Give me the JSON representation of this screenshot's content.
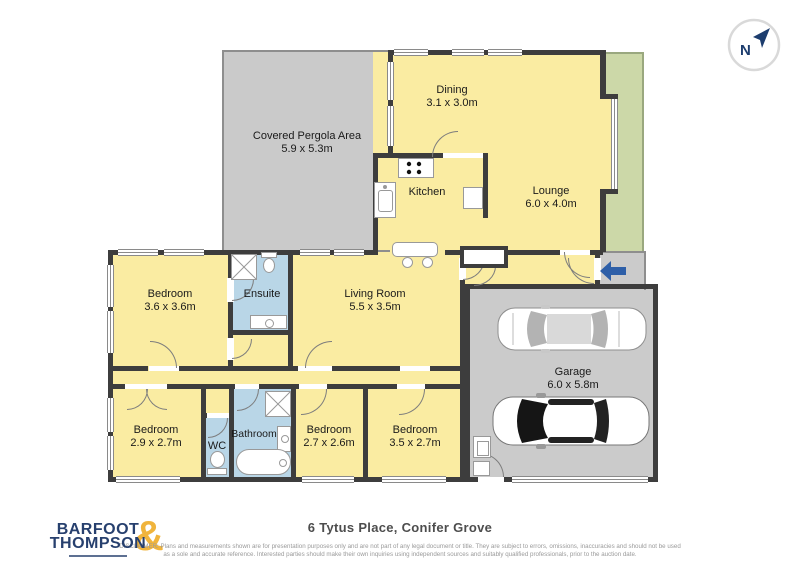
{
  "compass": {
    "label": "N"
  },
  "rooms": {
    "pergola": {
      "name": "Covered Pergola Area",
      "dims": "5.9 x 5.3m"
    },
    "dining": {
      "name": "Dining",
      "dims": "3.1 x 3.0m"
    },
    "kitchen": {
      "name": "Kitchen"
    },
    "lounge": {
      "name": "Lounge",
      "dims": "6.0 x 4.0m"
    },
    "living_room": {
      "name": "Living Room",
      "dims": "5.5 x 3.5m"
    },
    "bedroom_1": {
      "name": "Bedroom",
      "dims": "3.6 x 3.6m"
    },
    "ensuite": {
      "name": "Ensuite"
    },
    "bedroom_2": {
      "name": "Bedroom",
      "dims": "2.9 x 2.7m"
    },
    "wc": {
      "name": "WC"
    },
    "bathroom": {
      "name": "Bathroom"
    },
    "bedroom_3": {
      "name": "Bedroom",
      "dims": "2.7 x 2.6m"
    },
    "bedroom_4": {
      "name": "Bedroom",
      "dims": "3.5 x 2.7m"
    },
    "garage": {
      "name": "Garage",
      "dims": "6.0 x 5.8m"
    }
  },
  "footer": {
    "title": "6 Tytus Place, Conifer Grove",
    "logo_line1": "BARFOOT",
    "logo_line2": "THOMPSON",
    "logo_ampersand": "&",
    "disclaimer_line1": "DISCLAIMER: Plans and measurements shown are for presentation purposes only and are not part of any legal document or title. They are subject to errors, omissions, inaccuracies and should not be used",
    "disclaimer_line2": "as a sole and accurate reference. Interested parties should make their own inquiries using independent sources and suitably qualified professionals, prior to the auction date."
  },
  "icons": {
    "compass": "circle with N and north-east arrow",
    "entry_arrow": "blue left-pointing arrow"
  },
  "colors": {
    "room_fill": "#FAECA2",
    "wet_room_fill": "#B9D6E7",
    "outdoor_gray": "#CACACA",
    "deck_green": "#CCD8A8",
    "wall": "#3D3D3D",
    "entry_arrow": "#2E5FA8",
    "logo_navy": "#27406E",
    "logo_gold": "#F0B43C"
  }
}
